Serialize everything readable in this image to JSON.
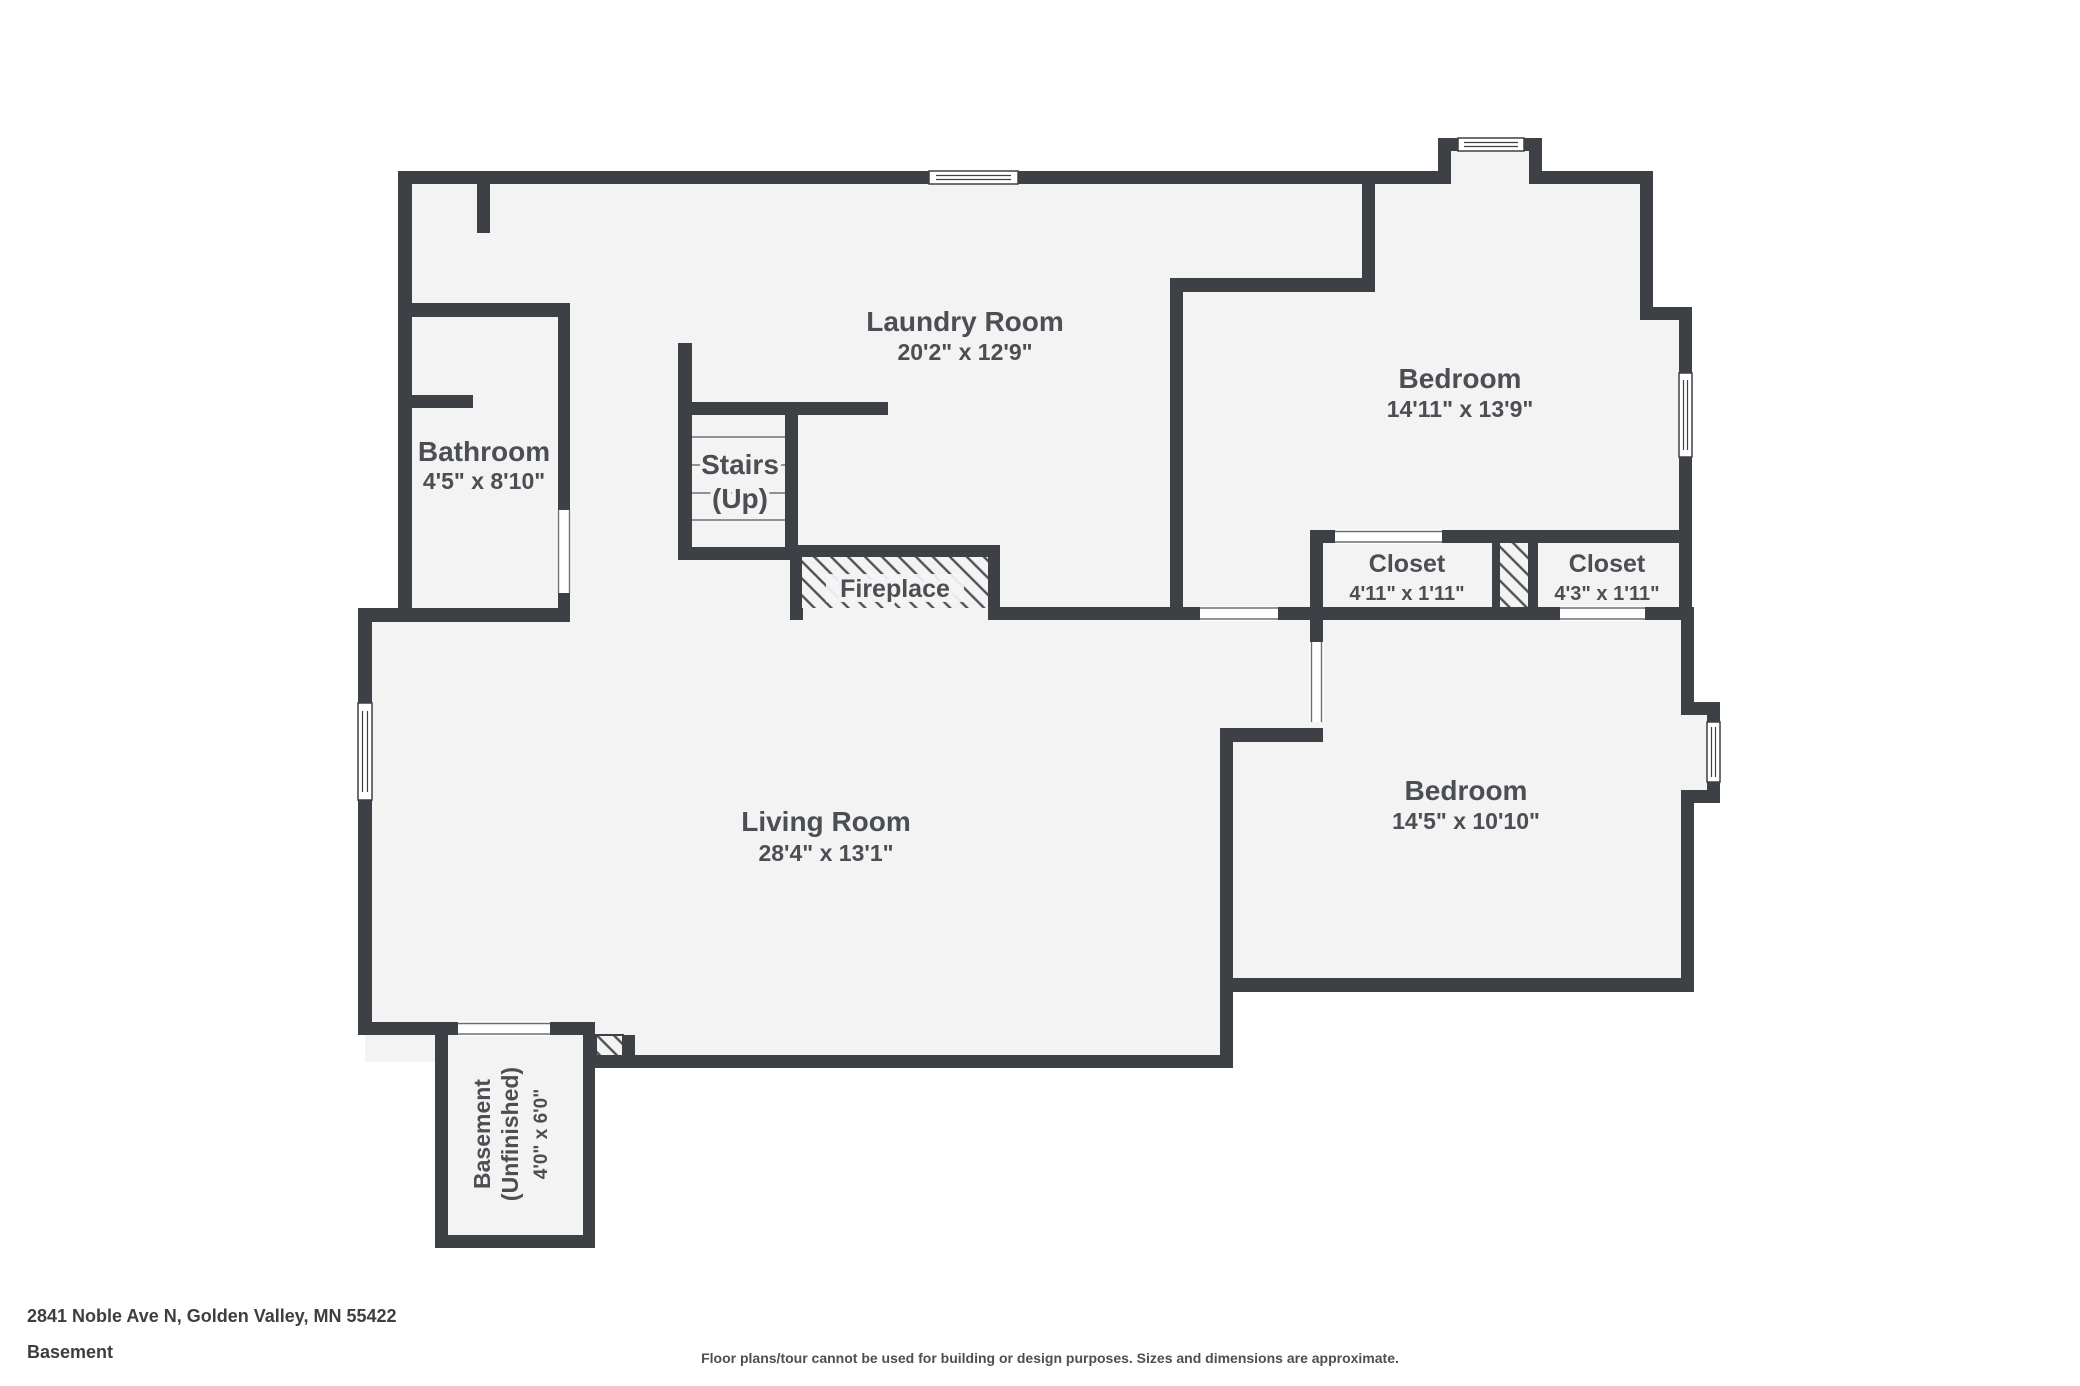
{
  "floorplan": {
    "address": "2841 Noble Ave N, Golden Valley, MN 55422",
    "level": "Basement",
    "disclaimer": "Floor plans/tour cannot be used for building or design purposes. Sizes and dimensions are approximate.",
    "colors": {
      "wall": "#3d4044",
      "floor": "#f3f3f4",
      "text": "#4b4e52"
    },
    "rooms": {
      "laundry": {
        "name": "Laundry Room",
        "dims": "20'2\" x 12'9\""
      },
      "bedroom1": {
        "name": "Bedroom",
        "dims": "14'11\" x 13'9\""
      },
      "bathroom": {
        "name": "Bathroom",
        "dims": "4'5\" x 8'10\""
      },
      "stairs": {
        "name": "Stairs",
        "sub": "(Up)"
      },
      "fireplace": {
        "name": "Fireplace"
      },
      "closet1": {
        "name": "Closet",
        "dims": "4'11\" x 1'11\""
      },
      "closet2": {
        "name": "Closet",
        "dims": "4'3\" x 1'11\""
      },
      "living": {
        "name": "Living Room",
        "dims": "28'4\" x 13'1\""
      },
      "bedroom2": {
        "name": "Bedroom",
        "dims": "14'5\" x 10'10\""
      },
      "basement": {
        "name": "Basement",
        "name2": "(Unfinished)",
        "dims": "4'0\" x 6'0\""
      }
    }
  }
}
